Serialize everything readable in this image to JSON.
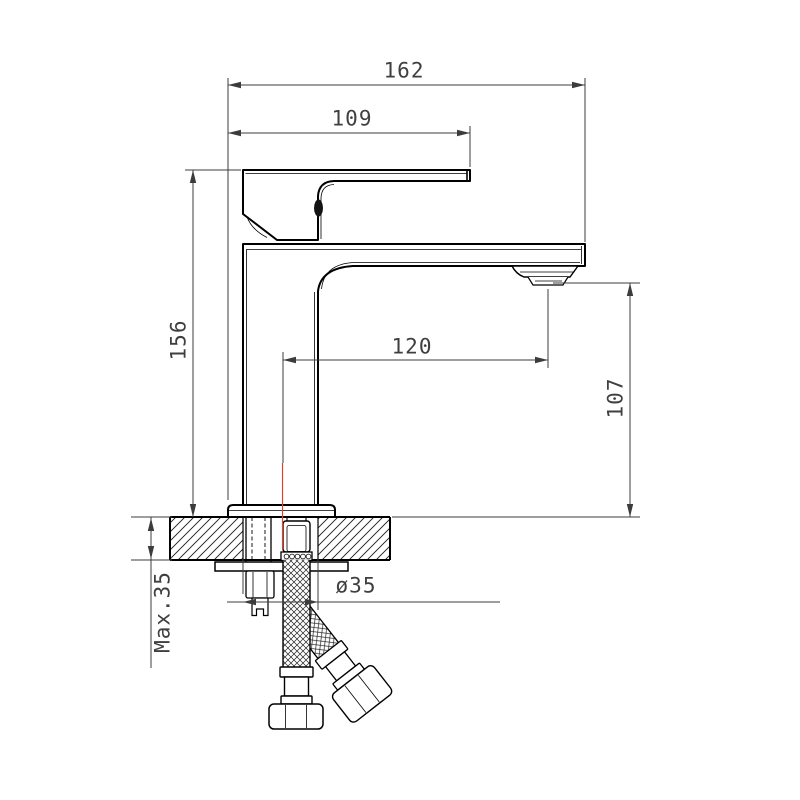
{
  "drawing": {
    "dim_overall_width": "162",
    "dim_handle_length": "109",
    "dim_body_height": "156",
    "dim_spout_reach": "120",
    "dim_spout_height": "107",
    "dim_max_mounting_thickness": "Max.35",
    "dim_hole_diameter": "ø35",
    "colors": {
      "object_line": "#000000",
      "dimension_line": "#3c3c3c",
      "centerline": "#b5524e",
      "background": "#ffffff"
    }
  }
}
